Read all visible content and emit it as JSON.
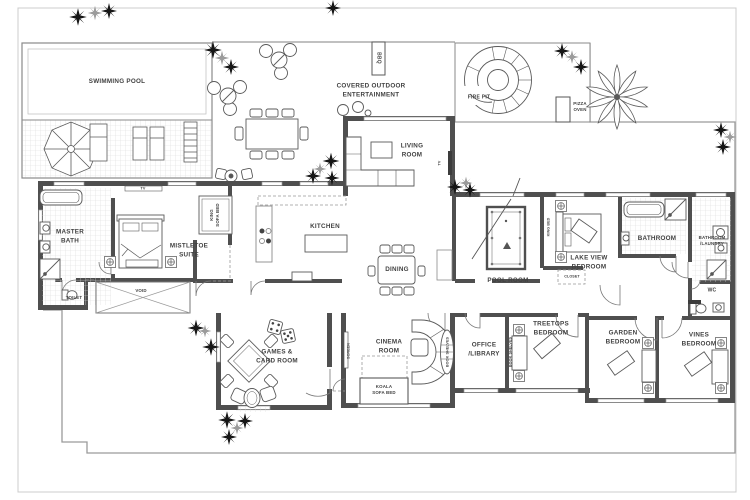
{
  "plan": {
    "areas": {
      "swimming_pool": "SWIMMING POOL",
      "covered_outdoor_entertainment": "COVERED OUTDOOR\nENTERTAINMENT",
      "bbq": "BBQ",
      "fire_pit": "FIRE PIT",
      "pizza_oven": "PIZZA\nOVEN"
    },
    "rooms": {
      "living_room": "LIVING\nROOM",
      "kitchen": "KITCHEN",
      "dining": "DINING",
      "master_bath": "MASTER\nBATH",
      "mistletoe_suite": "MISTLETOE\nSUITE",
      "toilet": "TOILET",
      "pool_room": "POOL ROOM",
      "lake_view_bedroom": "LAKE VIEW\nBEDROOM",
      "bathroom": "BATHROOM",
      "bathroom_laundry": "BATHROOM\n/LAUNDRY",
      "wc": "WC",
      "games_card_room": "GAMES &\nCARD ROOM",
      "cinema_room": "CINEMA\nROOM",
      "office_library": "OFFICE\n/LIBRARY",
      "treetops_bedroom": "TREETOPS\nBEDROOM",
      "garden_bedroom": "GARDEN\nBEDROOM",
      "vines_bedroom": "VINES\nBEDROOM"
    },
    "annotations": {
      "void": "VOID",
      "screen": "SCREEN",
      "book_shelves": "BOOK SHELVES",
      "koala_sofa_bed": "KOALA\nSOFA BED",
      "king_sofa_bed": "KING\nSOFA BED",
      "king_bed": "KING BED",
      "closet": "CLOSET",
      "tv": "TV"
    },
    "colors": {
      "wall": "#4f4f4f",
      "line": "#8f8f8f",
      "text": "#414141"
    }
  }
}
